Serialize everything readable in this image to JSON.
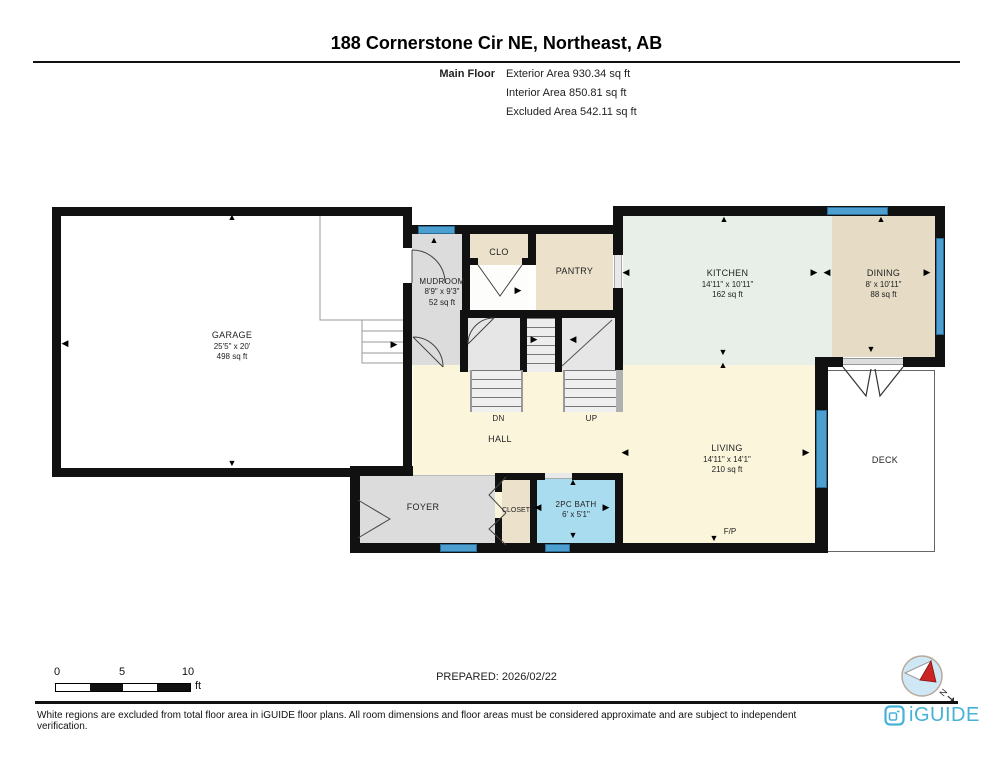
{
  "page": {
    "title": "188 Cornerstone Cir NE, Northeast, AB",
    "floor_label": "Main Floor",
    "stats": [
      "Exterior Area 930.34 sq ft",
      "Interior Area 850.81 sq ft",
      "Excluded Area 542.11 sq ft"
    ]
  },
  "rooms": {
    "garage": {
      "name": "GARAGE",
      "dims": "25'5\" x 20'",
      "area": "498 sq ft"
    },
    "mudroom": {
      "name": "MUDROOM",
      "dims": "8'9\" x 9'3\"",
      "area": "52 sq ft"
    },
    "clo": {
      "name": "CLO"
    },
    "pantry": {
      "name": "PANTRY"
    },
    "kitchen": {
      "name": "KITCHEN",
      "dims": "14'11\" x 10'11\"",
      "area": "162 sq ft"
    },
    "dining": {
      "name": "DINING",
      "dims": "8' x 10'11\"",
      "area": "88 sq ft"
    },
    "hall": {
      "name": "HALL"
    },
    "living": {
      "name": "LIVING",
      "dims": "14'11\" x 14'1\"",
      "area": "210 sq ft"
    },
    "foyer": {
      "name": "FOYER"
    },
    "closet": {
      "name": "CLOSET"
    },
    "bath": {
      "name": "2PC BATH",
      "dims": "6' x 5'1\""
    },
    "deck": {
      "name": "DECK"
    },
    "fireplace": "F/P",
    "stairs_down": "DN",
    "stairs_up": "UP"
  },
  "glyphs": {
    "up": "▲",
    "down": "▼",
    "left": "◀",
    "right": "▶"
  },
  "footer": {
    "scale_ticks": [
      "0",
      "5",
      "10"
    ],
    "scale_unit": "ft",
    "prepared": "PREPARED: 2026/02/22",
    "compass_north": "N",
    "disclaimer": "White regions are excluded from total floor area in iGUIDE floor plans. All room dimensions and floor areas must be considered approximate and are subject to independent verification.",
    "brand": "iGUIDE"
  },
  "colors": {
    "wall": "#111111",
    "window": "#4d9fcf",
    "kitchen": "#e7efe8",
    "dining": "#e6dcc6",
    "tan": "#ece2cc",
    "gray": "#dcdcdc",
    "cream": "#fbf5dc",
    "bath": "#aadcf0",
    "brand": "#47b2d8"
  }
}
